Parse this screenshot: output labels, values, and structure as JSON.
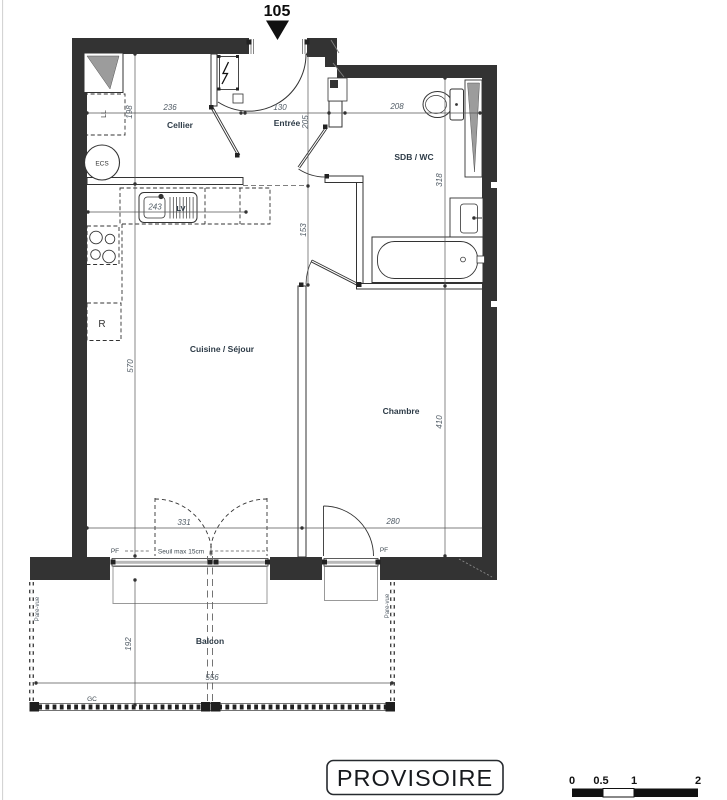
{
  "unit_label": "105",
  "rooms": {
    "cellier": "Cellier",
    "entree": "Entrée",
    "sdb_wc": "SDB / WC",
    "cuisine_sejour": "Cuisine / Séjour",
    "chambre": "Chambre",
    "balcon": "Balcon"
  },
  "dims": {
    "cellier_w": "236",
    "cellier_d": "198",
    "entree_w": "130",
    "entree_d": "205",
    "sdb_w": "208",
    "sdb_d": "318",
    "counter": "243",
    "couloir": "153",
    "sejour_w": "331",
    "sejour_d": "570",
    "chambre_w": "280",
    "chambre_d": "410",
    "balcon_w": "556",
    "balcon_d": "192"
  },
  "equipment": {
    "ll": "LL",
    "ecs": "ECS",
    "lv": "LV",
    "r": "R"
  },
  "openings": {
    "pf_sejour": "PF",
    "pf_chambre": "PF",
    "seuil": "Seuil max 15cm",
    "gc": "GC",
    "pare_vue_left": "Pare-vue",
    "pare_vue_right": "Pare-vue"
  },
  "stamp_label": "PROVISOIRE",
  "scale": {
    "t0": "0",
    "t05": "0.5",
    "t1": "1",
    "t2": "2"
  },
  "colors": {
    "wall": "#333333",
    "dim_text": "#4f5a64",
    "room_text": "#2d3b47"
  }
}
